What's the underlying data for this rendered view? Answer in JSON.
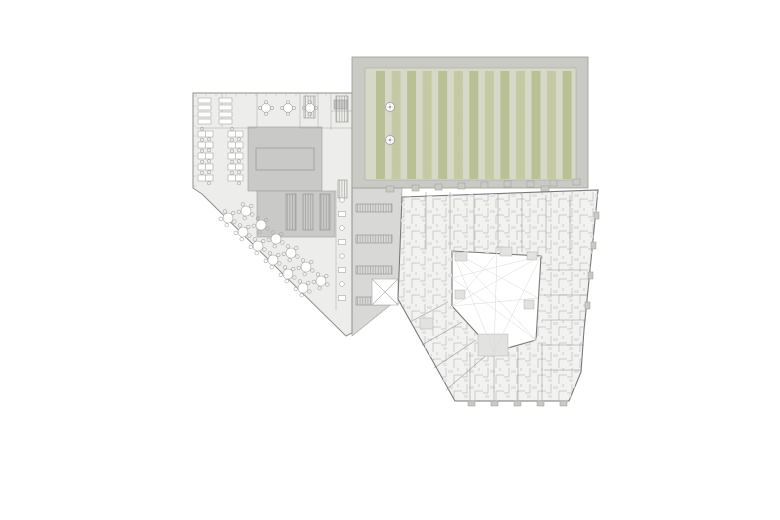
{
  "colors": {
    "canvas": "#ffffff",
    "officeFill": "#ededeb",
    "officeWall": "#8f8f8d",
    "coreFill": "#c9c9c7",
    "coreLine": "#9d9d9b",
    "plazaFill": "#d8d8d6",
    "plazaLine": "#ababa9",
    "frameFill": "#c9cac4",
    "frameLine": "#9b9b99",
    "fieldFill": "#d7d9c8",
    "stripeA": "#b9c095",
    "stripeB": "#c5caa4",
    "ringFill": "#f2f2f0",
    "ringWall": "#78787c",
    "roomLine": "#a6a6a4",
    "furniture": "#ffffff",
    "furnLine": "#a8a8a6",
    "hatch": "#90908c",
    "terrace": "#e2e2e0",
    "sightline": "#d8d8d6",
    "tick": "#b8b8b6"
  },
  "plan": {
    "green_roof": {
      "stripe_count": 13,
      "stripe_start_x": 376,
      "stripe_pitch": 15.55,
      "stripe_width": 9,
      "stripe_top": 71,
      "stripe_bottom": 179,
      "skylights": [
        [
          390,
          107
        ],
        [
          390,
          140
        ]
      ],
      "door_tabs": [
        386,
        541
      ]
    },
    "plaza": {
      "bike_rows_y": [
        204,
        235,
        266,
        297
      ],
      "bike_x": 356,
      "bike_w": 36,
      "bike_h": 8
    },
    "office": {
      "desk_rows": [
        [
          198,
          131
        ],
        [
          228,
          131
        ],
        [
          198,
          142
        ],
        [
          228,
          142
        ],
        [
          198,
          153
        ],
        [
          228,
          153
        ],
        [
          198,
          164
        ],
        [
          228,
          164
        ],
        [
          198,
          175
        ],
        [
          228,
          175
        ]
      ],
      "shelves": [
        [
          198,
          98
        ],
        [
          198,
          105
        ],
        [
          198,
          112
        ],
        [
          198,
          119
        ],
        [
          219,
          98
        ],
        [
          219,
          105
        ],
        [
          219,
          112
        ],
        [
          219,
          119
        ]
      ],
      "meeting_tables": [
        [
          266,
          108
        ],
        [
          288,
          108
        ],
        [
          310,
          108
        ]
      ],
      "cafeteria_tables": [
        [
          228,
          218
        ],
        [
          243,
          232
        ],
        [
          258,
          246
        ],
        [
          273,
          260
        ],
        [
          288,
          274
        ],
        [
          303,
          288
        ],
        [
          246,
          211
        ],
        [
          261,
          225
        ],
        [
          276,
          239
        ],
        [
          291,
          253
        ],
        [
          306,
          267
        ],
        [
          321,
          281
        ]
      ],
      "corridor_seats": [
        [
          342,
          200
        ],
        [
          342,
          214
        ],
        [
          342,
          228
        ],
        [
          342,
          242
        ],
        [
          342,
          256
        ],
        [
          342,
          270
        ],
        [
          342,
          284
        ],
        [
          342,
          298
        ]
      ],
      "stairs": [
        [
          304,
          96,
          11,
          22
        ],
        [
          336,
          96,
          12,
          26
        ],
        [
          286,
          194,
          10,
          36
        ],
        [
          303,
          194,
          10,
          36
        ],
        [
          320,
          194,
          10,
          36
        ],
        [
          338,
          180,
          9,
          18
        ]
      ],
      "partitions": [
        [
          300,
          93,
          300,
          128
        ],
        [
          318,
          93,
          318,
          128
        ],
        [
          331,
          93,
          331,
          130
        ],
        [
          300,
          128,
          352,
          128
        ],
        [
          331,
          111,
          352,
          111
        ],
        [
          196,
          128,
          257,
          128
        ],
        [
          257,
          93,
          257,
          127
        ],
        [
          222,
          93,
          222,
          127
        ],
        [
          336,
          190,
          336,
          310
        ]
      ]
    },
    "apartment": {
      "unit_walls": [
        [
          426,
          192,
          426,
          250
        ],
        [
          450,
          192,
          450,
          250
        ],
        [
          474,
          193,
          474,
          251
        ],
        [
          498,
          194,
          498,
          251
        ],
        [
          522,
          194,
          522,
          252
        ],
        [
          546,
          195,
          546,
          253
        ],
        [
          570,
          195,
          570,
          254
        ],
        [
          546,
          270,
          588,
          270
        ],
        [
          544,
          295,
          587,
          295
        ],
        [
          542,
          320,
          586,
          320
        ],
        [
          540,
          345,
          584,
          345
        ],
        [
          544,
          370,
          582,
          370
        ],
        [
          470,
          352,
          470,
          401
        ],
        [
          494,
          352,
          494,
          401
        ],
        [
          518,
          347,
          518,
          401
        ],
        [
          542,
          343,
          542,
          401
        ],
        [
          410,
          322,
          448,
          302
        ],
        [
          422,
          345,
          462,
          322
        ],
        [
          434,
          368,
          476,
          340
        ],
        [
          446,
          390,
          490,
          352
        ]
      ],
      "balcony_tabs_top": [
        [
          412,
          191
        ],
        [
          435,
          190
        ],
        [
          458,
          189
        ],
        [
          481,
          188
        ],
        [
          504,
          187
        ],
        [
          527,
          187
        ],
        [
          550,
          186
        ],
        [
          573,
          185
        ]
      ],
      "balcony_tabs_bottom": [
        [
          468,
          401
        ],
        [
          491,
          401
        ],
        [
          514,
          401
        ],
        [
          537,
          401
        ],
        [
          560,
          401
        ]
      ],
      "balcony_tabs_right": [
        [
          594,
          212
        ],
        [
          591,
          242
        ],
        [
          588,
          272
        ],
        [
          585,
          302
        ]
      ],
      "terraces": [
        [
          455,
          252,
          12,
          9
        ],
        [
          500,
          247,
          12,
          9
        ],
        [
          527,
          252,
          10,
          8
        ],
        [
          455,
          290,
          10,
          9
        ],
        [
          524,
          300,
          10,
          9
        ],
        [
          478,
          334,
          30,
          22
        ],
        [
          420,
          318,
          13,
          11
        ]
      ],
      "sightlines": [
        [
          452,
          251,
          536,
          340
        ],
        [
          452,
          251,
          494,
          352
        ],
        [
          541,
          256,
          452,
          306
        ],
        [
          541,
          256,
          494,
          352
        ],
        [
          497,
          253,
          494,
          352
        ],
        [
          497,
          253,
          452,
          306
        ],
        [
          538,
          298,
          452,
          251
        ],
        [
          538,
          298,
          452,
          306
        ],
        [
          452,
          278,
          536,
          340
        ],
        [
          452,
          278,
          541,
          256
        ]
      ]
    },
    "window_ticks": {
      "top": {
        "y": 93,
        "x0": 196,
        "x1": 350,
        "step": 10
      },
      "left": {
        "x": 193,
        "y0": 96,
        "y1": 186,
        "step": 10
      }
    }
  }
}
